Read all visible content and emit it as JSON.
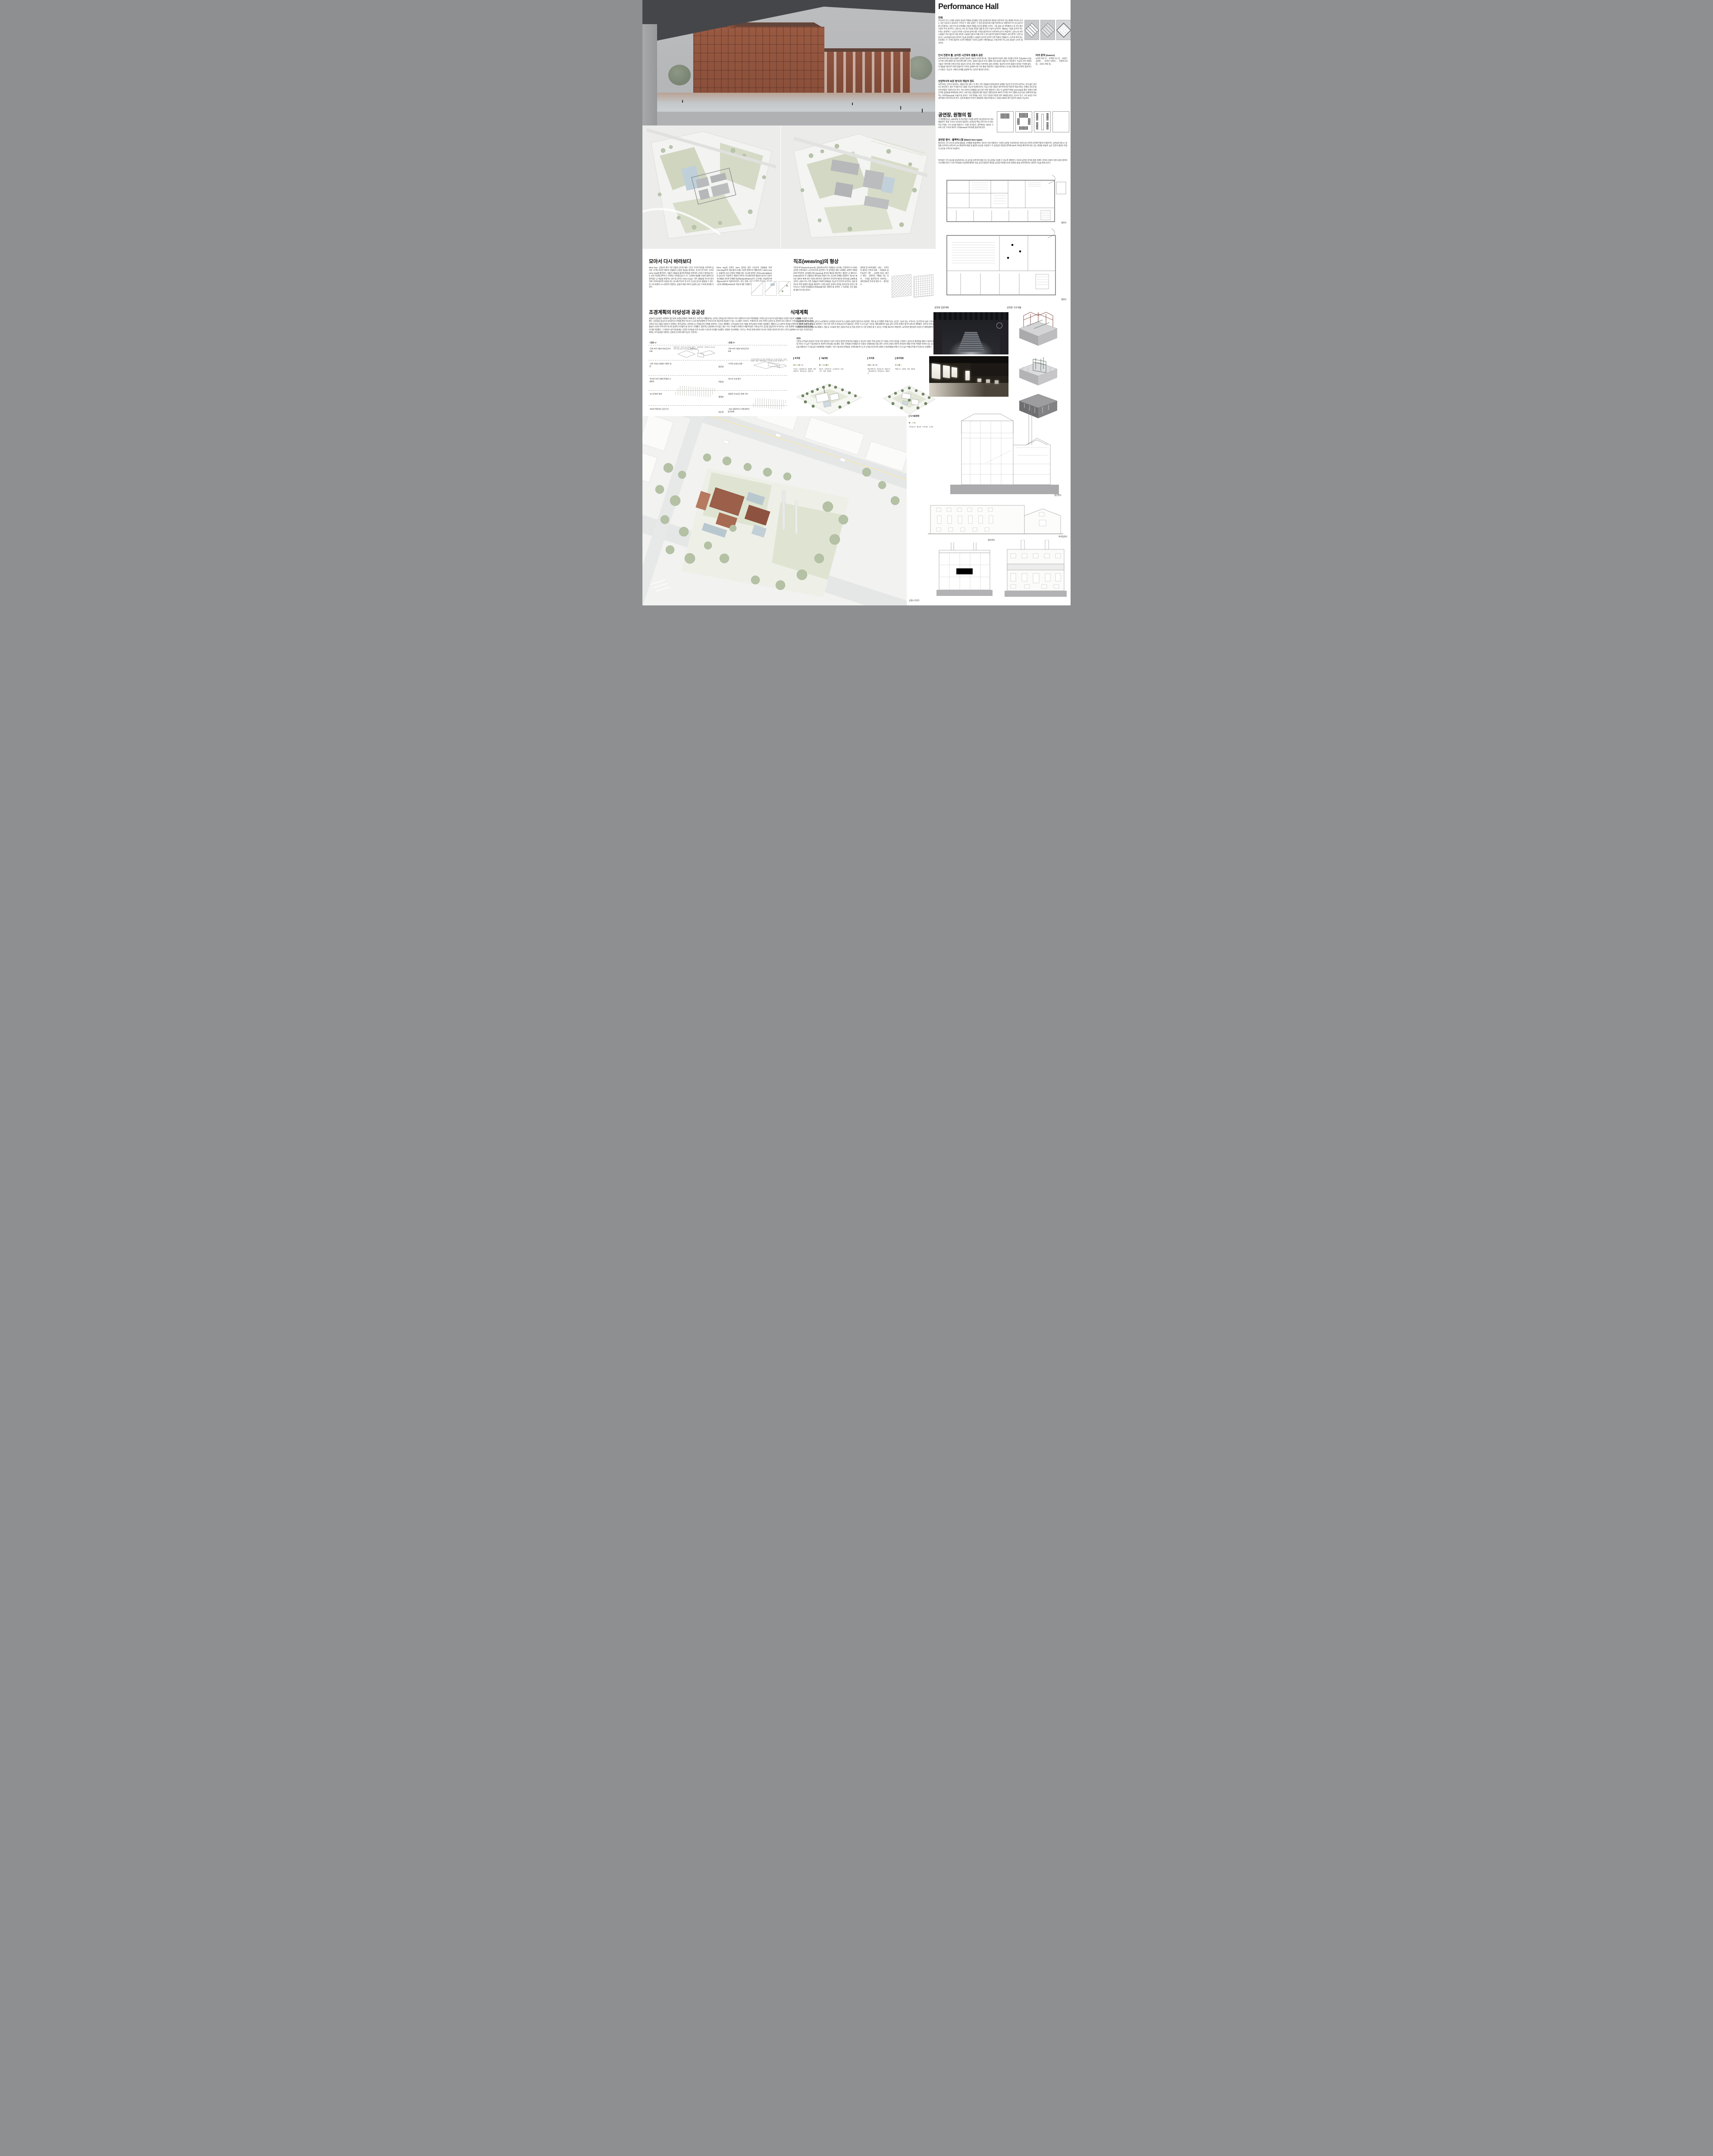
{
  "board": {
    "title": "Performance Hall"
  },
  "premise": {
    "heading": "전제",
    "body": "우리나라 초기 근대화 산업의 중요한 역할을 담당했던 전방·일산방직의 편린을 보존하여 다음 세대에 역사로 남기는 일은 타당하고 중요하다. 주어진 두 개의 공원은 구 전방·일산방직의 터를 전면적으로 개발하여 주거 및 상업 복합 단지화하는 사업 부지 중 문화예술 거점의 역할을 하도록 할애된 곳이다. 그중 공원 1은 화력발전소 및 기타 생산시설이 주로 남겨지고, 공원 2는 숙소 및 식당을 포함한 생활 및 관리 시설이 남겨진다. 왜(why) 그들을 남겨야 하는 이유는 분명하다. '노동의 가치와 노동자의 삶'에 대한 기억을 물리적으로 보존하여 남기기 위함이다. 공원 1의 보존 시설들은 주로 생산과 직접 관련된 시설들이 클러스터를 이루고 있어 물리적·집합적 존재감이 강한 편이다. 반면 공원 2는 노동자들의 삶과 관리의 기능을 담당했던 시설들이 남겨져 상이한 건축 어휘의 건물들이 느슨하게 퍼져 있는 모양새다. 두 구역의 물리적·시간적 변별성은 각자의 공원이 어떻게(how) 구성되어야 하느냐의 중요한 단서가 될 것이다.",
    "diagram_icons": [
      "sawtooth-mass-solid",
      "sawtooth-mass-hatched",
      "site-diamond-outline"
    ]
  },
  "perception": {
    "heading": "인식 전환의 틀, 상이한 시간대의 충돌과 공존",
    "body": "보존되어야 할 산업시설물이 공원의 중요한 내용이 되어야 할 때, 그들의 물리적 속성이 새로 조성될 단지의 지금(when) 모습과 어떤 관계 설정이 될 것인지에 대한 단서는 공원의 형상과 프로그램에 가장 중요한 내용으로 작용한다. 지금의 건축 어휘와 기술로 이루어질 전체 단지의 형상과 과거의 건축 어휘로 이루어질 공원 사이에는 형상적·인지적 충돌이 일어날 수밖에 없다. 이 충돌을 해소하기 위한 방법으로 각자의 공원에 서로 다른 틀을 적용하여 그들을 바라보는 인식을 전환시킬 전략이 필요하다고 보았다. '지금'과 '그때'의 관계를 설정해 주는 장치가 필요한 것이다."
  },
  "trace": {
    "heading": "터의 흔적 (trance)",
    "body": "남겨진 보존 건… 유추할 수도 있… 보았다. 공원의 … 조경과 건축의 … 연결하고자 함… 의자나 벽의 형…"
  },
  "preservation": {
    "heading": "산업역사의 보존 방식과 개입의 정도",
    "body": "보존이라는 단어가 내포하는 개입의 폭은 넓다. 이 경우 기존 건물들의 원래 물리적 상태를 가능한 한 온전히 보존하는 것이 옳은 길이라고 판단한다. 새로 부과될 프로그램의 기능과 특성에 따르는 조심스러운 개입은 필수적이지만 '창조적 개입'이라는 전제의 과도한 물리적 변형은 지양하기로 한다. 역사 보존의 임계점을 넘지 않기 위한 결정이다. 대신 각 공원에 부과될 (mirroring)의 틀이 미래의 전체 단지와 공원들을 매개해 줄 것이다. 보존 대상 건물들에 대한 개입은 현행 법규와 새로이 부과된 프로그램에 조심스럽고 정확하게 대응하는 외과적(surgical) 수술이 될 것이다. 크게 적벽돌, 미장 그리고 타일로 마감된 외부 재료를 살리는 것으로 하고, 구조 보강은 주로 내부에서 이루어지도록 한다. 심하게 훼손된 부분은 원재료에 가깝게 복원하고, 단종된 재료의 경우 창조적 개입이 가능하다."
  },
  "hall": {
    "heading": "공연장, 원형의 힘",
    "body": "구 화력발전소는 1930년대 초기의 철골 구조를 보존한 채 공연장으로 리모델링된다. 철골 구조의 시간성과 형상미는 공연장의 핵심 건축 요소가 되며, 주요 부재는 구조 보강을 제외하고 그대로 유지된다. 내부에서는 새로운 구조와 기존 구조의 대비가 극적(theatral) 이미지를 형성하게 된다."
  },
  "blackbox": {
    "heading": "공연장 형식 : 블랙박스형 (black box type)",
    "body": "발전소의 구조 조건과 공연장 활용을 고려했을 때 블랙박스 형식이 가장 적합하다. 다양한 공연을 수용하면서도 발전소의 건축적 성격에 부합하기 때문이다. 공연장의 매스는 원형을 유지하되 남측으로 2m 확장하여 화물 및 출연자 동선을 수용한다. 주 공연장은 발전실 영역에 205석 객석을 배치하여 밀도 있는 환경을 만들며, 높은 단면과 평면의 조합이 공간을 극적으로 완성한다.",
    "body2": "변전실은 수직 동선을 담당하면서도 원 공간을 보존하여 팝업 전시 및 공연을 수용할 수 있도록 계획한다. 이로써 공연장 관객과 팝업 이벤트 관객의 흐름이 자연스럽게 겹치며 시너지를 만든다. 또한 지하층을 지상화해 쾌적한 진입 공간과 충분한 화장실 공간을 마련함으로써 '원형의 힘'을 보존하면서도 현대적 기능을 충족시킨다.",
    "seating_icons": [
      "end-stage-seating",
      "arena-seating",
      "traverse-seating",
      "flat-floor"
    ]
  },
  "gather": {
    "heading": "모아서 다시 바라보다",
    "col1": "Mirror loop : 공원1의 경우 기존 건물의 규모와 재료 그리고 구조적 특성을 고려하여 상이한 크기와 비슷한 재료의 건물들의 군집된 형상을 엮어내는 견고한 콘크리트 구조의 mirror loop를 제안한다. 거울은 건물들의 물리적 환경을 투영하여 고유의 수경관을 만드는 일과 역사를 반추하고 기억하는 의미를 담는다. 또 그곳에서 발생할 다양한 종류의 콘텐츠들은 곧 세상을 반영하는 일이 될 것이다. Mirror loop는 기존 건물들을 하나로 묶어 전체 구조에 물리적 보강을 하는 동시에 미디어 및 조각 전시장 등으로 활용될 수 있다. 빈 고리 바깥의 도시 환경과 직접하는 공원과 짝을 이루어 공원의 공간 구조에 깊이를 더한다.",
    "col2": "Mirror loop의 안쪽은 15cm 깊이의 얕은 수공간이 건물들을 투영(mirroring)하여 건물 클러스터를 고유한 환경으로 재창조한다. Mirror loop는 효율적인 동선 순환의 역할을 맡는 동시에 정적인 관조(contemplation)의 장소로도 작용한다. 계절과 하루의 시간대에 따른 활용의 형식이 다양하게 연출될 것이며 전체를 대상화(objectification)하고 궁극에는 관념화된 배경(ground)으로 작용하게 된다. 과거, 현재 그리고 미래를 아우르는 중요한 시간의 매개체(vehicle)로 작동하기를 기대한다."
  },
  "weaving": {
    "heading": "직조(weaving)의 형상",
    "col1": "직조된 바닥(weaved ground): 공원2에 남겨진 건물들의 시간대는 다양하여 각 시대의 상이한 건축어휘가 느슨하게 퍼져 공존한다. 이 상이함은 해당 시대에는 보편적 어휘였음에 주목하여, 상이함을 짜는(weaving) 바닥의 패턴을 제안한다. 패턴은 곧 매트릭스(matrix)화되어 각 건물들의 영역성을 만들어 주는 동시에 전체를 연결한다. 제시된 새로운 레이어 위에 보존 수종의 레이어가 겹쳐지며 기하학적 패턴의 경직성을 상쇄해 줄 것이다. 공원2 역시 기존 건물들의 어휘적 정체성을 가능한 한 온전히 보전하는 것을 원칙으로 하여 형태적 개입을 제한한다. 전체 공원은 문화적 성격을 강하게 띨 것이다. 매트릭스는 다양한 문화활동의 판(field)을 짜는 체계가 될 것이며, 그 가운데는 모든 활동에 열린 터가 될 것이다.",
    "col2": "경비실 및 비지터센터 : 상당… 고려하여 새로운 건축과 대비… 직원들의 업무공간은 기존 … 공유할 이유는 없다고 판단… 강화하는 역할을 하는 것이… 구성을 물리적으로 보완하는… 내에 필요한 안내 및 편의·수… 판단된다."
  },
  "landscape": {
    "heading": "조경계획의 타당성과 공공성",
    "body": "공원1의 공공성은 사면에서 접근성과 순환동선체계 구축에 있다. 보존하고 재활용하는 남겨진 건축공간의 주변으로 프로그램적으로 또한 주변현황을 고려한 공간구성으로 방문객들의 다양한 이용적 요구도를 수용할 수 있게 했다. 공연장을 중심으로 방사형으로 연결될 뿐만 아니라 도시의 발전방향에 유기적으로 잘 적응하며 대응할 수 있는 시스템적 구성이다. 주제적으로 보면 건축이 공연장 등 문화적 프로그램으로 구성되어 있다면 외부공간은 건축의 프로그램을 지원하고 연계하는 외부공연장, 너른마당 등 전체공간의 주제를 보완하는 구조로 계획했다. 조각공원의 프로그램을 외부공원의 주제로 설정했다. 예향의 도시 광주의 특성을 반영하고 기존의 남겨진 건축물들이 조경과 어우러져 하나의 풍경적 조각물이 될 것으로 기대했다. 일반적인 공원에서 보기힘든 많은 수의 구조물이 존재하기 때문에 많은 식재 등으로 공간을 답답하게 하기보다는 너른 풍경에 오브제(조각)처럼 풍경화 되기를 희망했다. 그 비워진 너른 마당들에는 다양한 조각들을 유치 전시할 수 있도록 토대를 조성했다. 변형된 직교체계의 그리드는 주어진 땅에 새겨진 하나의 거대한 대지조각이 된다. 흔히 공원에서 보기 힘든 이러한 동선체계는 조각공원을 지향하는 공원의 논리에 의해 가능한 구성이다."
  },
  "matrix": {
    "park1_title": "<공원 1>",
    "park2_title": "<공원 2>",
    "categories": [
      "경관성",
      "이용성",
      "생태성",
      "공공성"
    ],
    "park1_rows": [
      "-건축 프로그램과 외부공간의 조화",
      "-기존 수림과 연계한 수평적 경관",
      "-특수한 프로그램에 적합한 시설배치",
      "-유니트화된 체계",
      "-외부로 확장하는 동선구조"
    ],
    "park2_rows": [
      "-건축 프로그램과 외부공간의 조화",
      "-수직적 교림의 경관",
      "-최소의 시설 배치",
      "-통합적 녹지공간 체계 구축",
      "- 내부 집중적이고 외면강화의 동선체계"
    ],
    "park1_facilities": [
      "재생의 정원",
      "기획전시장 및 화장실",
      "역사관",
      "그림자의정원",
      "카페테리아, 레스토랑",
      "테이크아웃 커피점 및 외부정원",
      "카페(휴게공간)"
    ],
    "park2_facilities": [
      "작가들의 창작실 및 전시공간, 창작편의시설",
      "전시장 및 역사관",
      "시민아틀리에",
      "카페1",
      "카페2(젤라또)",
      "키즈카페 및 도서관",
      "운영사무실"
    ]
  },
  "planting": {
    "heading": "식재계획",
    "park1_label": "공원1",
    "park1_body": "공원외곽으로 큰 나무를 심어 도시산책로의 시작점이 되도록 하고 공원의 상징적 경관으로 조성한다. 책의 숲 등 특별한 주제가 있는 공간은 그늘이 있는 수목으로, 장기적으로 숲의 구조로 자랄 수 있도록 하층 식재 등을 보완한다. 다만 다른 지역 즉 문화공간으로 활용되는 지역은 수고가 높은 낙우송, 메타세쿼이아 등을 심어 시각적 장애가 생기지 않도록 계획했다. 관목과 지피 등도 최소화하여 시각적 단절을 최소화했다. 건물 등 구조물이 많은 공원의 특성 상 하층 관목은 또 다른 장애가 될 수 있다는 우려를 해소하기 위함이다. 요약하면 열린경관 조성이 큰 계획방향이다",
    "park2_label": "공원2",
    "park2_body": "기존의 나무들이 중요한 가치로 이미 점유하고 있어 기존의 경관적 분위기와 어울릴 수 있도록 수량은 적게 심지만 큰 수형의 나무로 경관을 구성한다. 중앙으로 통경축을 꽤하고 외곽으로 수고 및 지하고 가 높은 수종선정으로 경관적 연속성을 의도했다. 많은 건축물이 존재함으로 다층의 식재경관을 만들 경우 시각적 단절과 경관적 연속성이 해칠 우려로 특별한 목적이 있는 휴게공간 등을 제외하곤 수고중심의 식재계획을 수립했다. 기존 수종과의 연계성을 고려해 팽나무 등 큰 교목을 포인트에 식재하고 경관연출을 위해 수고가 높은 백합나무를 주수종으로 선정했다",
    "palettes": [
      {
        "title": "초지원",
        "plants": [
          "낙우송",
          "노랑말채나무",
          "황매화",
          "메타세쿼이아",
          "종작살나무",
          "병꽃나무"
        ]
      },
      {
        "title": "그늘정원",
        "plants": [
          "팽나무",
          "공조팝나무",
          "수수꽃다리",
          "꼬랑사초",
          "관중",
          "털머위"
        ]
      },
      {
        "title": "초지원",
        "plants": [
          "메타세쿼이아",
          "종작살나무",
          "병꽃나무",
          "메타세쿼이아",
          "종작살나무",
          "병꽃나무"
        ]
      },
      {
        "title": "음지정원",
        "plants": [
          "백합나무",
          "진달래",
          "관중",
          "털머위"
        ]
      },
      {
        "title": "도시숲정원",
        "plants": [
          "팥배나무",
          "나무수국",
          "낙상홍",
          "꼬리풀",
          "원평소국",
          "추명국"
        ]
      },
      {
        "title": "습지정원",
        "plants": [
          "낙우송",
          "철쭉",
          "말발도리",
          "돌나물",
          "꽃창포",
          "부처꽃"
        ]
      },
      {
        "title": "습지원",
        "plants": [
          "백합나무",
          "말발도리",
          "산수국",
          "추명국",
          "꽃창포",
          "부처꽃"
        ]
      },
      {
        "title": "도시숲정원",
        "plants": [
          "가막살나무",
          "불두화",
          "노루오줌",
          "수크령"
        ]
      }
    ]
  },
  "drawings": {
    "elevation_plan_label": "공연장 입면계획",
    "structure_label": "공연장 구조개념",
    "plan1_label": "평면도",
    "plan2_label": "평면도",
    "long_section_label": "종단면도",
    "cross_section_label": "횡단면도",
    "north_elevation_label": "북측입면도",
    "aerial_label": "공원2 조감도"
  }
}
